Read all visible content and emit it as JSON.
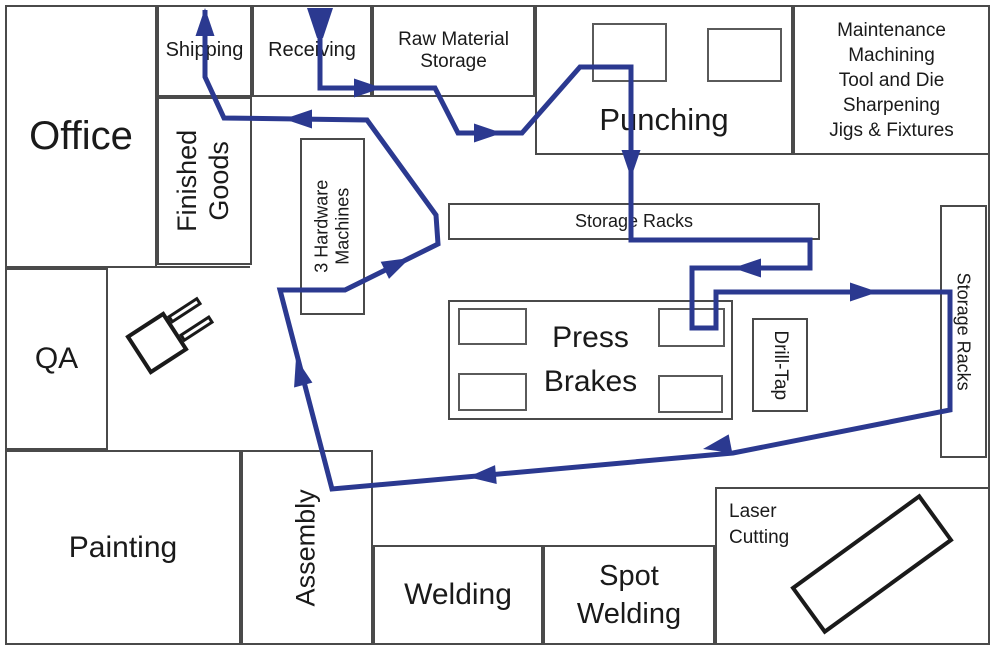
{
  "canvas": {
    "title": "Facility layout with material flow path",
    "accent_color": "#2b3990",
    "line_color": "#4a4a4a",
    "background": "#ffffff"
  },
  "rooms": {
    "office": {
      "label": "Office"
    },
    "shipping": {
      "label": "Shipping"
    },
    "receiving": {
      "label": "Receiving"
    },
    "raw_material": {
      "lines": [
        "Raw Material",
        "Storage"
      ]
    },
    "punching": {
      "label": "Punching"
    },
    "maintenance": {
      "lines": [
        "Maintenance",
        "Machining",
        "Tool and Die",
        "Sharpening",
        "Jigs & Fixtures"
      ]
    },
    "finished_goods": {
      "lines": [
        "Finished",
        "Goods"
      ]
    },
    "hardware": {
      "lines": [
        "3 Hardware",
        "Machines"
      ]
    },
    "storage_racks_h": {
      "label": "Storage Racks"
    },
    "storage_racks_v": {
      "label": "Storage Racks"
    },
    "press_brakes": {
      "lines": [
        "Press",
        "Brakes"
      ]
    },
    "drill_tap": {
      "label": "Drill-Tap"
    },
    "qa": {
      "label": "QA"
    },
    "painting": {
      "label": "Painting"
    },
    "assembly": {
      "label": "Assembly"
    },
    "welding": {
      "label": "Welding"
    },
    "spot_welding": {
      "lines": [
        "Spot",
        "Welding"
      ]
    },
    "laser_cutting": {
      "lines": [
        "Laser",
        "Cutting"
      ]
    }
  },
  "flow_path": {
    "color": "#2b3990",
    "stroke_width": 5,
    "points": "320,32 320,88 435,88 458,133 522,133 580,67 631,67 631,240 810,240 810,268 692,268 692,328 716,328 716,292 950,292 950,410 733,453 332,489 280,290 345,290 438,244 436,215 367,120 224,118 205,77 205,10",
    "entry_funnel": "307,8 333,8 323,38 317,38",
    "arrow_length": 28,
    "arrow_halfwidth": 9.5,
    "arrows": [
      {
        "x": 382,
        "y": 88,
        "angle": 0
      },
      {
        "x": 502,
        "y": 133,
        "angle": 0
      },
      {
        "x": 631,
        "y": 178,
        "angle": 90
      },
      {
        "x": 733,
        "y": 268,
        "angle": 180
      },
      {
        "x": 878,
        "y": 292,
        "angle": 0
      },
      {
        "x": 703,
        "y": 449,
        "angle": 169
      },
      {
        "x": 468,
        "y": 477,
        "angle": 175
      },
      {
        "x": 296,
        "y": 358,
        "angle": -105
      },
      {
        "x": 410,
        "y": 258,
        "angle": -26
      },
      {
        "x": 284,
        "y": 119,
        "angle": 180
      },
      {
        "x": 205,
        "y": 8,
        "angle": -90
      }
    ]
  }
}
